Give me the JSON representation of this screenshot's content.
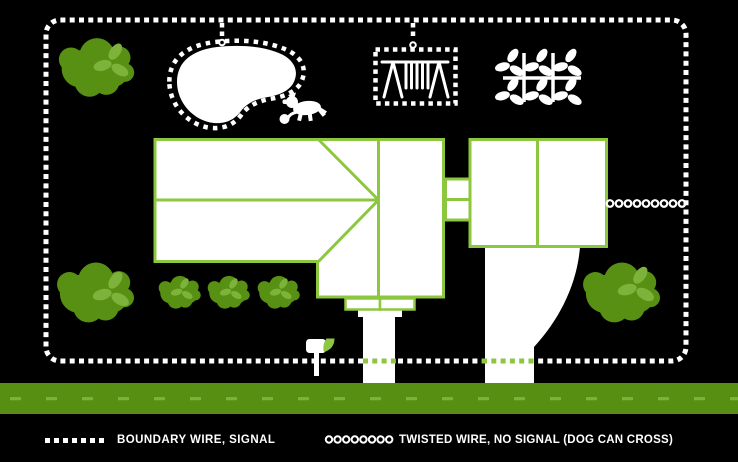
{
  "diagram": {
    "type": "yard-invisible-fence-layout",
    "legend": {
      "boundary_label": "BOUNDARY WIRE, SIGNAL",
      "twisted_label": "TWISTED WIRE, NO SIGNAL (DOG CAN CROSS)"
    },
    "colors": {
      "background": "#000000",
      "wire": "#ffffff",
      "structure_outline": "#8dc63f",
      "foliage": "#579012",
      "leaf_accent": "#7db33a",
      "road": "#578f12",
      "road_dash": "#7fb23a"
    },
    "icons": [
      "dog-icon",
      "mailbox-icon",
      "swing-set-icon",
      "garden-plant-icon",
      "bush-icon",
      "pool-shape"
    ],
    "elements": [
      "boundary-wire",
      "pool-exclusion-loop",
      "swing-set-exclusion-loop",
      "twisted-wire",
      "house",
      "garage",
      "breezeway",
      "porch",
      "front-steps",
      "walkway",
      "driveway",
      "road",
      "garden",
      "bushes"
    ]
  }
}
